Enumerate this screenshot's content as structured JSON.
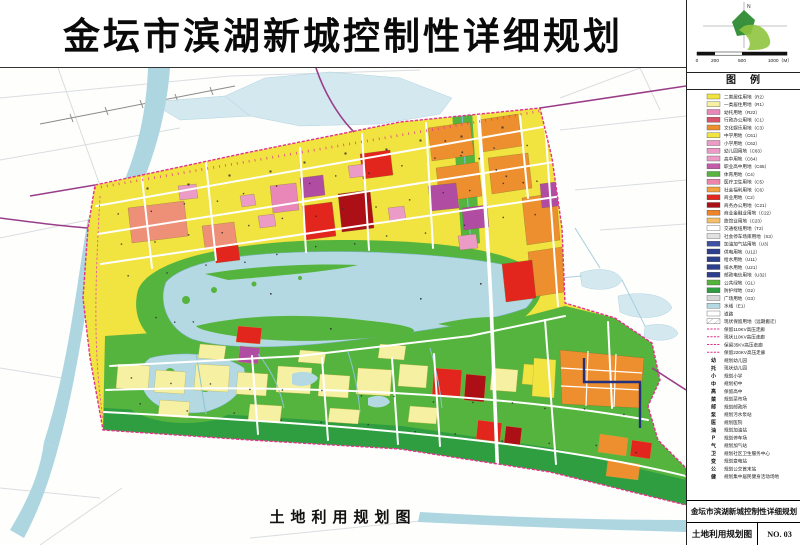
{
  "title": "金坛市滨湖新城控制性详细规划",
  "map_caption": "土地利用规划图",
  "compass": {
    "north_label": "N"
  },
  "scale_bar": {
    "labels": [
      "0",
      "200",
      "500",
      "1000（M）"
    ]
  },
  "legend": {
    "header": "图　例",
    "items": [
      {
        "label": "二类居住用地（R2）",
        "type": "swatch",
        "color": "#f1e340"
      },
      {
        "label": "一类居住用地（R1）",
        "type": "swatch",
        "color": "#f6f0a2"
      },
      {
        "label": "幼托用地（R22）",
        "type": "swatch",
        "color": "#e887b8"
      },
      {
        "label": "行政办公用地（C1）",
        "type": "swatch",
        "color": "#d9536b"
      },
      {
        "label": "文化娱乐用地（C3）",
        "type": "swatch",
        "color": "#ee8f2f"
      },
      {
        "label": "中学用地（C61）",
        "type": "swatch",
        "color": "#f1e340"
      },
      {
        "label": "小学用地（C62）",
        "type": "swatch",
        "color": "#eb9bc5"
      },
      {
        "label": "幼儿园用地（C63）",
        "type": "swatch",
        "color": "#eb9bc5"
      },
      {
        "label": "高中用地（C64）",
        "type": "swatch",
        "color": "#eb9bc5"
      },
      {
        "label": "职业高中用地（C65）",
        "type": "swatch",
        "color": "#c45ba8"
      },
      {
        "label": "体育用地（C4）",
        "type": "swatch",
        "color": "#55b43e"
      },
      {
        "label": "医疗卫生用地（C5）",
        "type": "swatch",
        "color": "#ef84ad"
      },
      {
        "label": "社会福利用地（C6）",
        "type": "swatch",
        "color": "#f2a23f"
      },
      {
        "label": "商业用地（C2）",
        "type": "swatch",
        "color": "#e3261d"
      },
      {
        "label": "商务办公用地（C21）",
        "type": "swatch",
        "color": "#ac1016"
      },
      {
        "label": "商业金融业用地（C22）",
        "type": "swatch",
        "color": "#f08228"
      },
      {
        "label": "旅馆业用地（C23）",
        "type": "swatch",
        "color": "#f5c069"
      },
      {
        "label": "交通枢纽用地（T2）",
        "type": "outline",
        "color": "#ffffff"
      },
      {
        "label": "社会停车场库用地（S3）",
        "type": "swatch",
        "color": "#e2e2e2"
      },
      {
        "label": "加油加气站用地（U3）",
        "type": "swatch",
        "color": "#3f51a3"
      },
      {
        "label": "供电用地（U12）",
        "type": "swatch",
        "color": "#2c3e8c"
      },
      {
        "label": "给水用地（U11）",
        "type": "swatch",
        "color": "#2c3e8c"
      },
      {
        "label": "排水用地（U21）",
        "type": "swatch",
        "color": "#2c3e8c"
      },
      {
        "label": "邮政电信用地（U32）",
        "type": "swatch",
        "color": "#2c3e8c"
      },
      {
        "label": "公共绿地（G1）",
        "type": "swatch",
        "color": "#55b43e"
      },
      {
        "label": "防护绿地（G2）",
        "type": "swatch",
        "color": "#2f9e40"
      },
      {
        "label": "广场用地（G3）",
        "type": "swatch",
        "color": "#d8d8d8"
      },
      {
        "label": "水域（E1）",
        "type": "swatch",
        "color": "#b4d9e2"
      },
      {
        "label": "道路",
        "type": "outline",
        "color": "#ffffff"
      },
      {
        "label": "现状保留用地（远期搬迁）",
        "type": "hatch",
        "color": "#ffffff"
      },
      {
        "label": "保留110KV高压走廊",
        "type": "dash",
        "color": "#e1338c"
      },
      {
        "label": "现状110KV高压走廊",
        "type": "dash",
        "color": "#e1338c"
      },
      {
        "label": "保留35KV高压走廊",
        "type": "dash",
        "color": "#e1338c"
      },
      {
        "label": "保留220KV高压走廊",
        "type": "dash",
        "color": "#e1338c"
      },
      {
        "label": "规划幼儿园",
        "type": "symbol",
        "symbol": "幼"
      },
      {
        "label": "现状幼儿园",
        "type": "symbol",
        "symbol": "托"
      },
      {
        "label": "规划小学",
        "type": "symbol",
        "symbol": "小"
      },
      {
        "label": "规划初中",
        "type": "symbol",
        "symbol": "中"
      },
      {
        "label": "保留高中",
        "type": "symbol",
        "symbol": "高"
      },
      {
        "label": "规划菜市场",
        "type": "symbol",
        "symbol": "菜"
      },
      {
        "label": "规划邮政所",
        "type": "symbol",
        "symbol": "邮"
      },
      {
        "label": "规划污水泵站",
        "type": "symbol",
        "symbol": "泵"
      },
      {
        "label": "规划医院",
        "type": "symbol",
        "symbol": "医"
      },
      {
        "label": "规划加油站",
        "type": "symbol",
        "symbol": "油"
      },
      {
        "label": "规划停车场",
        "type": "symbol",
        "symbol": "P"
      },
      {
        "label": "规划加气站",
        "type": "symbol",
        "symbol": "气"
      },
      {
        "label": "规划社区卫生服务中心",
        "type": "symbol",
        "symbol": "卫"
      },
      {
        "label": "规划变电站",
        "type": "symbol",
        "symbol": "变"
      },
      {
        "label": "规划公交首末站",
        "type": "symbol",
        "symbol": "公"
      },
      {
        "label": "规划集中居民健身活动场地",
        "type": "symbol",
        "symbol": "健"
      }
    ]
  },
  "title_block": {
    "project": "金坛市滨湖新城控制性详细规划",
    "drawing": "土地利用规划图",
    "number": "NO. 03"
  },
  "colors": {
    "boundary": "#e1338c",
    "residential_r2": "#f1e340",
    "residential_r1": "#f6f0a2",
    "commercial": "#e3261d",
    "business": "#ac1016",
    "culture": "#ee8f2f",
    "school_pink": "#eb9bc5",
    "purple_parcel": "#b14ca3",
    "salmon": "#ee8f78",
    "park_green": "#55b43e",
    "shelter_green": "#2f9e40",
    "water": "#b4d9e2",
    "utility_navy": "#2c3e8c",
    "outside_road_purple": "#9a3d88"
  }
}
